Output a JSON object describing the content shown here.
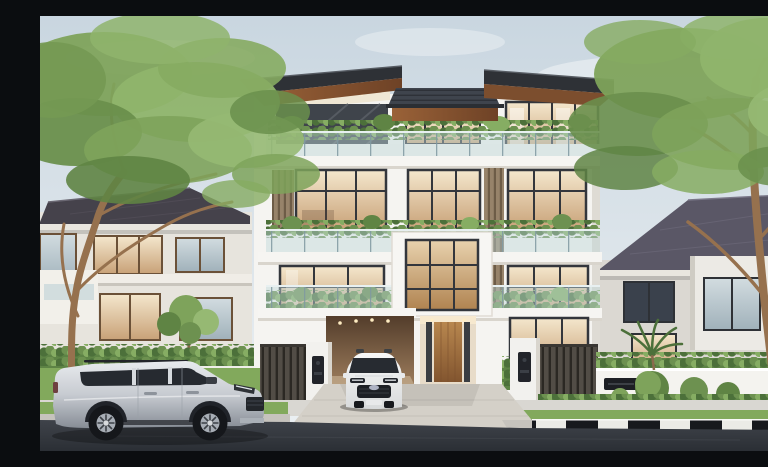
{
  "meta": {
    "type": "photorealistic architectural render",
    "description": "Modern four-storey white villa with dark overhanging flat roofs, wood soffits, glass-balustrade balconies filled with planter greenery, vertical timber louvres, a carport with a white SUV, a timber entrance door and intercom gate pillars; flanked by two grey two-storey neighbour houses and large leafy trees; a silver SUV is parked on the asphalt street beside a black-and-white striped kerb, grass verge and concrete sidewalk under a pale blue-grey sky."
  },
  "palette": {
    "sky_top": "#c9d6e0",
    "sky_horizon": "#edf1f3",
    "cloud_white": "#ffffff",
    "wall_white": "#f5f4f1",
    "wall_shadow": "#dedbd4",
    "frame_dark": "#33363c",
    "roof_dark": "#2e3136",
    "soffit_wood": "#9a6238",
    "louvre_wood": "#97836a",
    "door_wood": "#b8874f",
    "carport_wood": "#9b7b5b",
    "glass_rail": "#bfd6da",
    "hedge_green": "#5d8345",
    "leaf_dark": "#5f8444",
    "leaf_mid": "#7ea35b",
    "leaf_light": "#96b973",
    "lawn_green": "#82a95c",
    "trunk_brown": "#96714e",
    "neighbor_wall": "#e7e4dd",
    "neighbor_roof_left": "#45424b",
    "neighbor_roof_right": "#5a5766",
    "garden_wall": "#f4f3ef",
    "pillar_white": "#f2f1ee",
    "fence_dark": "#524d46",
    "intercom_black": "#22242a",
    "letterbox_black": "#1d1f24",
    "sidewalk": "#d9d7d2",
    "driveway": "#d4d0c8",
    "asphalt": "#3f434a",
    "curb_white": "#ebebe6",
    "curb_black": "#17191d",
    "car_silver": "#c7cbd1",
    "car_white": "#f7f8f8",
    "car_glass": "#262a30",
    "tyre_black": "#15171b"
  },
  "scene": {
    "buildings": {
      "main_house": {
        "storeys": 4,
        "features": [
          "overhanging dark roof wings",
          "wood soffits",
          "glass balcony balustrades",
          "rooftop and balcony planter greenery",
          "vertical timber louvres",
          "carport",
          "timber entrance door",
          "white gate pillars with intercoms",
          "dark slat fences"
        ]
      },
      "left_house": {
        "storeys": 2,
        "features": [
          "dark hip roof",
          "brown framed windows",
          "front hedge",
          "small garden tree"
        ]
      },
      "right_house": {
        "storeys": 2,
        "features": [
          "grey-violet hip roof",
          "dark framed windows",
          "white garden wall with letterbox",
          "topiary bushes",
          "palm plant"
        ]
      }
    },
    "vehicles": [
      {
        "name": "silver-suv",
        "body": "SUV",
        "colour": "silver",
        "view": "side",
        "location": "street kerb"
      },
      {
        "name": "white-suv",
        "body": "SUV",
        "colour": "white",
        "view": "front",
        "location": "driveway carport"
      }
    ],
    "landscape": [
      "large left tree",
      "large right tree",
      "lawns",
      "hedges",
      "grass verge",
      "black-and-white striped kerb",
      "asphalt road",
      "concrete sidewalk",
      "concrete driveway"
    ]
  }
}
